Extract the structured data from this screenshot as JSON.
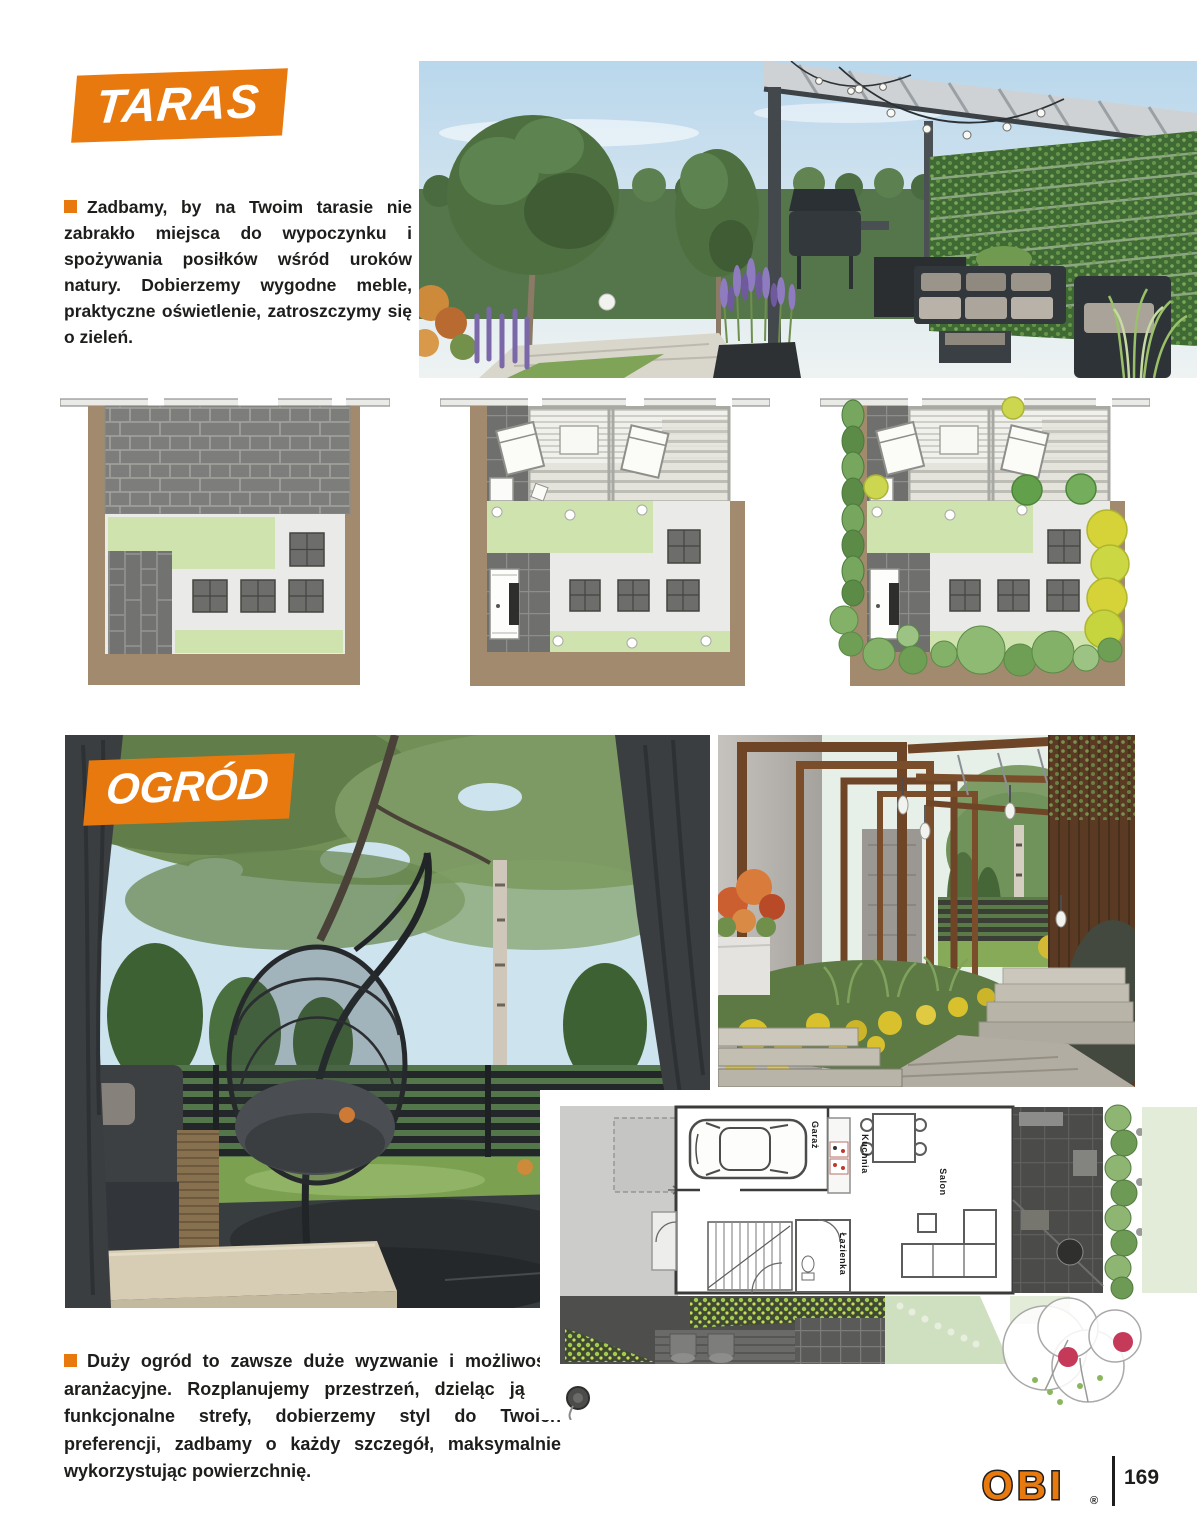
{
  "sections": {
    "taras": {
      "banner_label": "TARAS",
      "intro": "Zadbamy, by na Twoim tarasie nie zabrakło miejsca do wypoczynku i spożywania posiłków wśród uroków natury. Dobierzemy wygodne meble, praktyczne oświetlenie, zatroszczymy się o zieleń."
    },
    "ogrod": {
      "banner_label": "OGRÓD",
      "outro": "Duży ogród to zawsze duże wyzwanie i możliwości aranżacyjne. Rozplanujemy przestrzeń, dzieląc ją na funkcjonalne strefy, dobierzemy styl do Twoich preferencji, zadbamy o każdy szczegół, maksymalnie wykorzystując powierzchnię."
    }
  },
  "house_plan": {
    "labels": {
      "garage": "Garaż",
      "kitchen": "Kuchnia",
      "living_room": "Salon",
      "bathroom": "Łazienka"
    }
  },
  "footer": {
    "brand": "OBI",
    "registered_mark": "®",
    "page_number": "169"
  },
  "colors": {
    "accent_orange": "#e8790f",
    "banner_text": "#ffffff",
    "body_text": "#1d1d1b",
    "plan_brown": "#a18a6d",
    "plan_lawn_green": "#cfe3ae"
  },
  "icons": {
    "bullet": "orange-square-bullet",
    "compass": "plan-compass-icon"
  }
}
